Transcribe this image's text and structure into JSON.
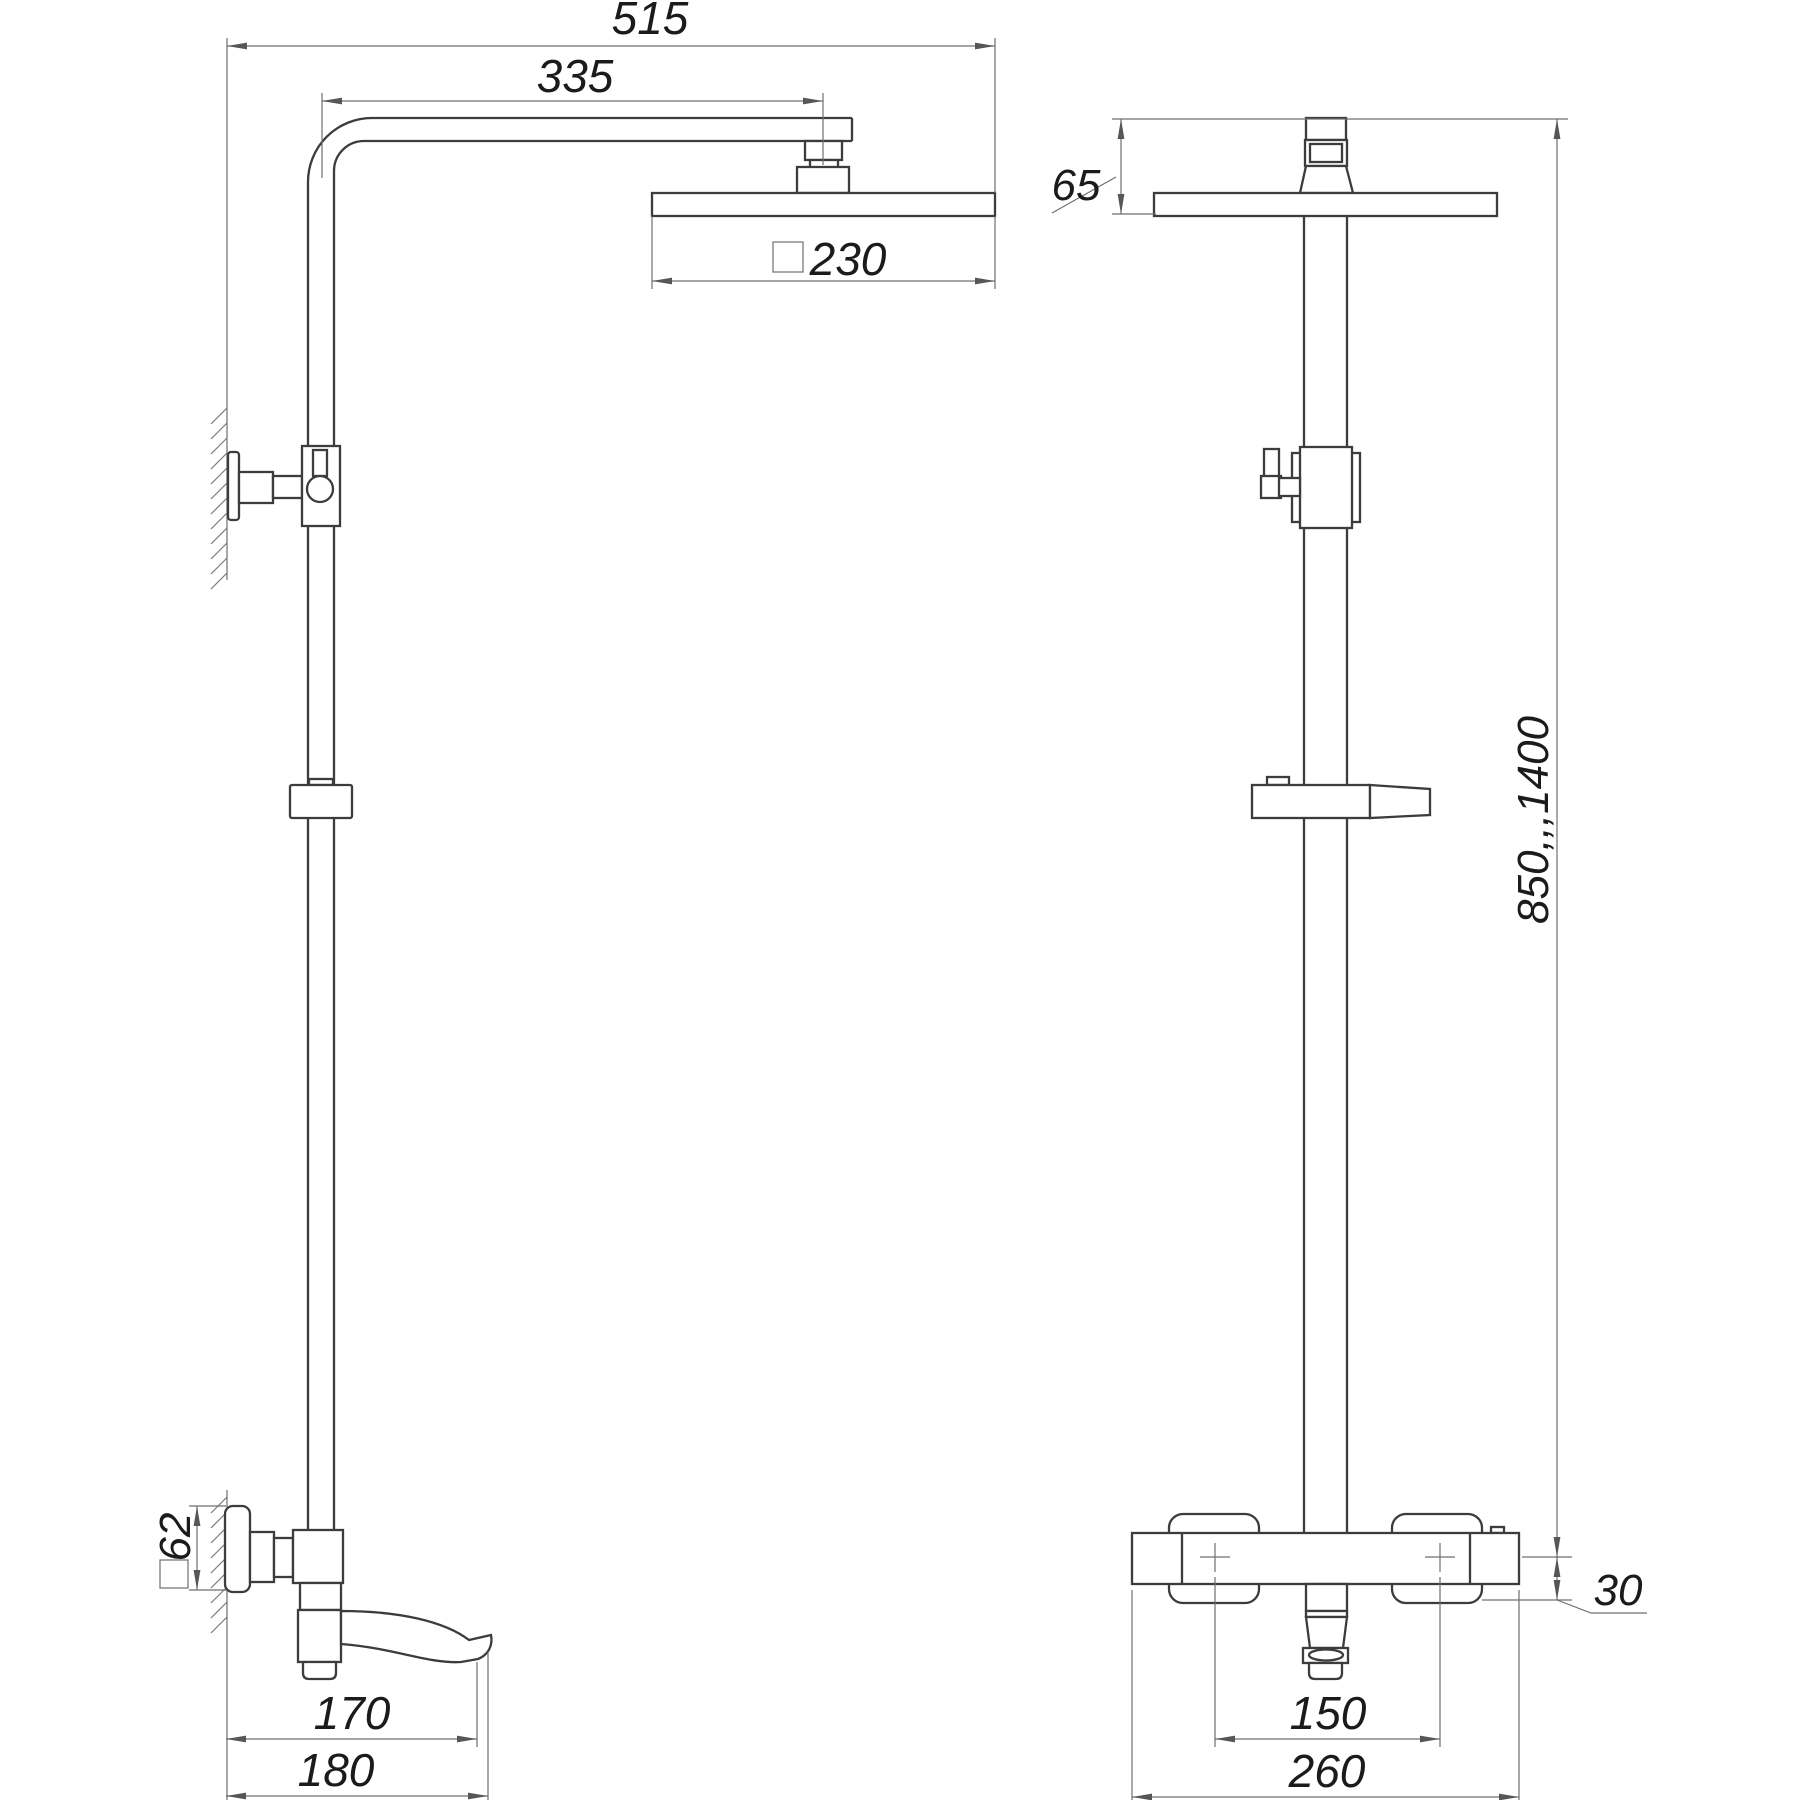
{
  "drawing": {
    "kind": "shower-system-technical-drawing",
    "views": {
      "side_view": "side-view",
      "front_view": "front-view"
    },
    "dims": {
      "width_total": "515",
      "arm_offset": "335",
      "head_square": "230",
      "head_assembly_height": "65",
      "pole_height_range": "850,,,1400",
      "wall_plate_square": "62",
      "spout_reach": "170",
      "spout_total": "180",
      "inlet_spacing": "150",
      "mixer_width": "260",
      "mixer_drop": "30"
    },
    "symbols": {
      "square_symbol": "square-section-symbol"
    },
    "colors": {
      "object_line": "#3c3c3c",
      "dimension_line": "#6f6f6f",
      "text": "#1b1b1b",
      "background": "#ffffff"
    }
  }
}
